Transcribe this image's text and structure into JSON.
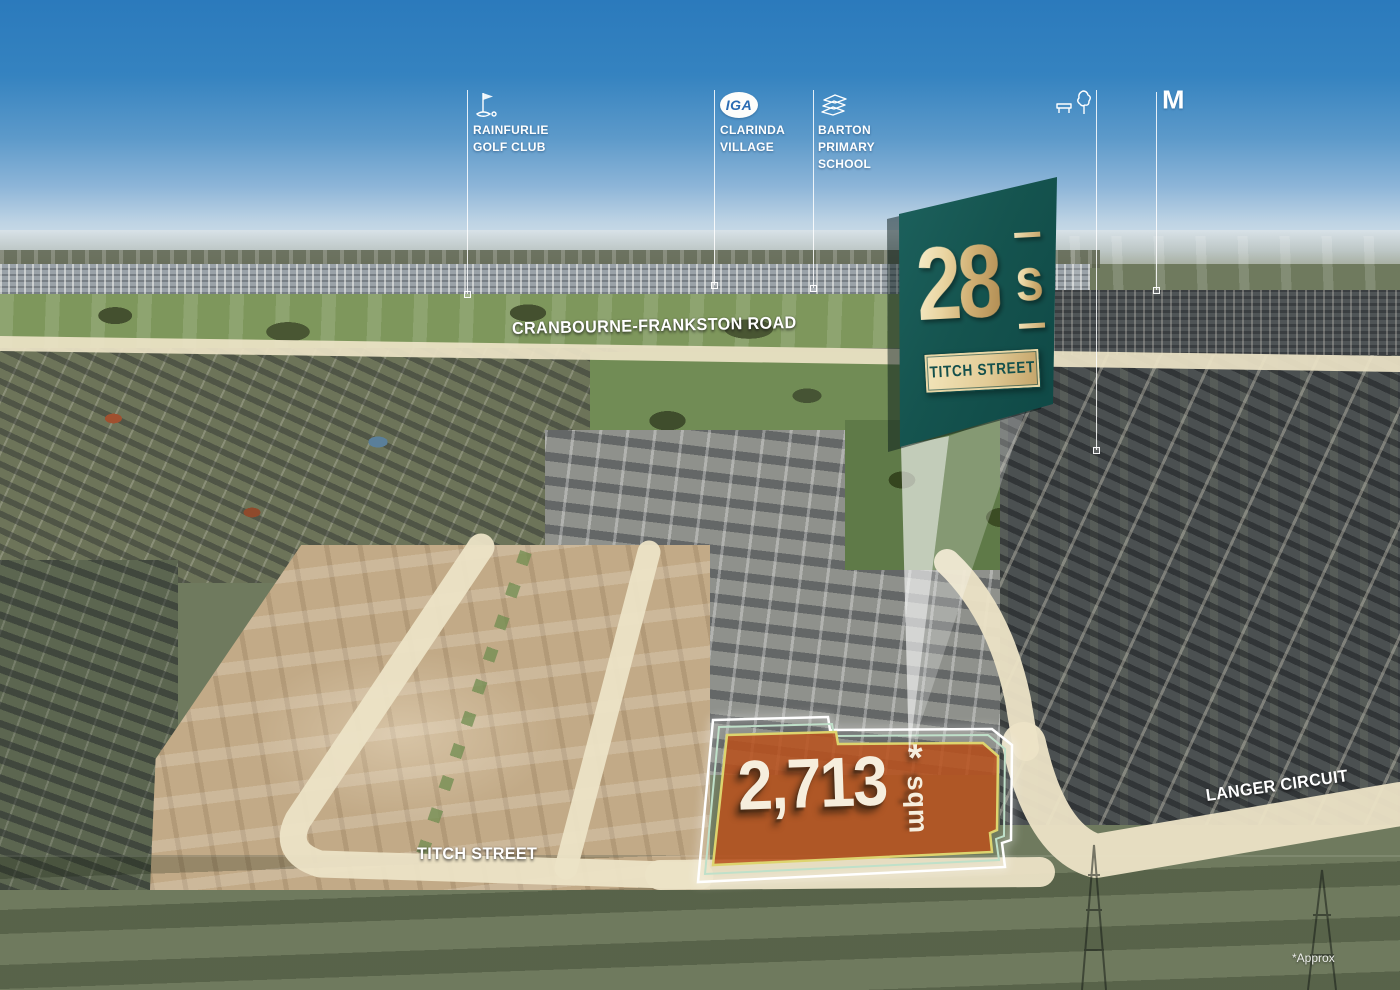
{
  "markers": [
    {
      "name": "rainfurlie-golf-club",
      "icon": "golf-flag-icon",
      "lines": [
        "RAINFURLIE",
        "GOLF CLUB"
      ]
    },
    {
      "name": "clarinda-village",
      "icon": "iga-logo",
      "logo_text": "IGA",
      "lines": [
        "CLARINDA",
        "VILLAGE"
      ]
    },
    {
      "name": "barton-primary-school",
      "icon": "school-books-icon",
      "lines": [
        "BARTON",
        "PRIMARY",
        "SCHOOL"
      ]
    },
    {
      "name": "local-park",
      "icon": "park-bench-tree-icon",
      "lines": [
        "LOCAL PARK"
      ]
    },
    {
      "name": "mcdonalds",
      "icon": "mcdonalds-m-logo",
      "logo_text": "M",
      "lines": []
    }
  ],
  "road_labels": {
    "highway": "CRANBOURNE-FRANKSTON ROAD",
    "titch": "TITCH STREET",
    "langer": "LANGER CIRCUIT"
  },
  "banner": {
    "big_number": "28",
    "suffix": "s",
    "plaque": "TITCH STREET"
  },
  "lot": {
    "area": "2,713",
    "asterisk": "*",
    "unit": "sqm"
  },
  "footnote": "*Approx",
  "colors": {
    "banner_teal_dark": "#0d4543",
    "banner_teal_light": "#1e6460",
    "gold_light": "#f2e4ba",
    "gold_dark": "#b08c52",
    "road_cream": "#ece3c6",
    "lot_orange": "#b8521f",
    "lot_outline_yellow": "#ddd46e",
    "lot_outline_mint": "#bfe0c9",
    "lot_outline_white": "#ffffff",
    "sky_blue": "#2b7abc"
  }
}
